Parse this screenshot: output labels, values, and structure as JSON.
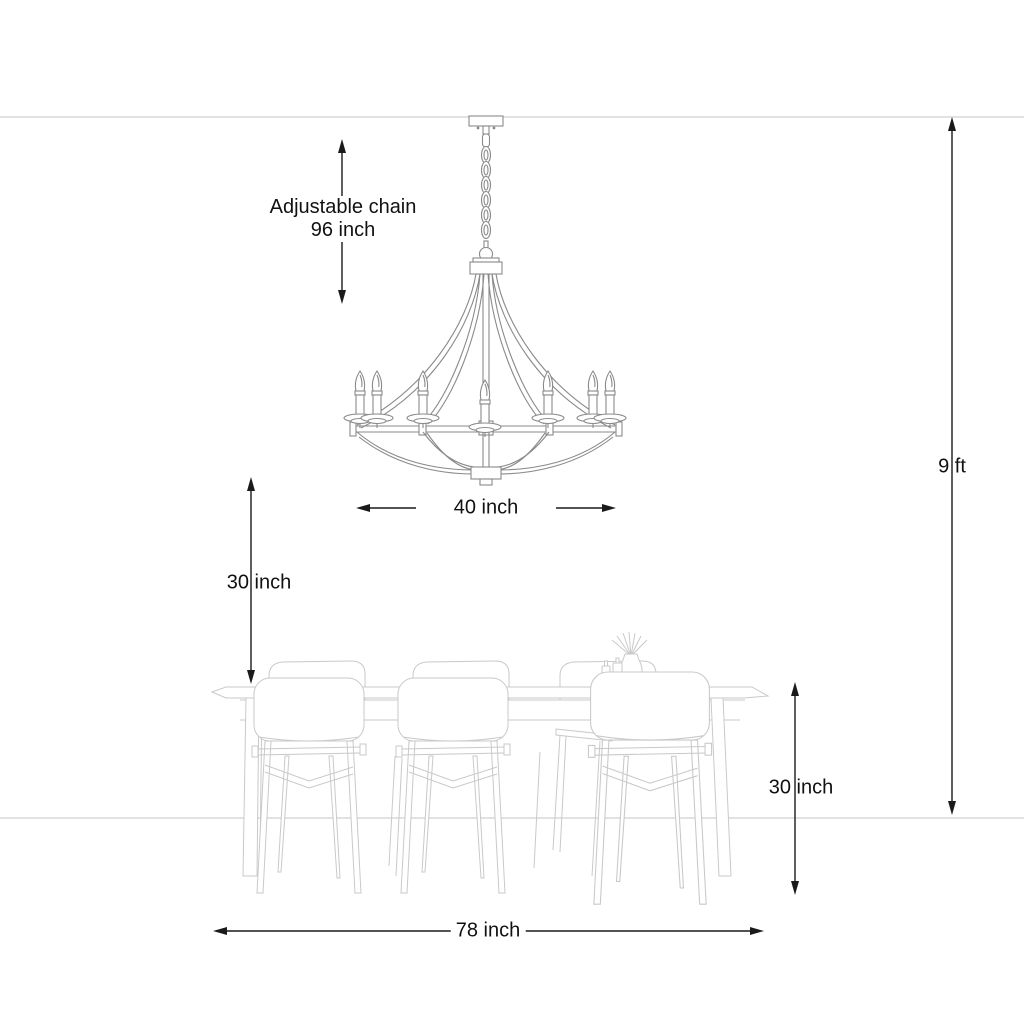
{
  "scene": {
    "type": "product-dimension-diagram",
    "objects": {
      "chandelier": "candle chandelier on adjustable chain",
      "table": "dining table",
      "chairs": "dining chairs",
      "decor": "reed diffuser and bottles on table"
    }
  },
  "colors": {
    "background": "#ffffff",
    "room_line": "#d8d8d8",
    "furniture_line": "#c9c9c9",
    "fixture_line": "#8a8a8a",
    "dimension_line": "#1a1a1a",
    "label_text": "#111111"
  },
  "dimensions": {
    "chain": {
      "label_line1": "Adjustable chain",
      "label_line2": "96 inch",
      "value": 96,
      "unit": "inch"
    },
    "fixture_width": {
      "label": "40 inch",
      "value": 40,
      "unit": "inch"
    },
    "fixture_clearance": {
      "label": "30 inch",
      "value": 30,
      "unit": "inch"
    },
    "ceiling_height": {
      "label": "9 ft",
      "value": 9,
      "unit": "ft"
    },
    "table_height": {
      "label": "30 inch",
      "value": 30,
      "unit": "inch"
    },
    "table_length": {
      "label": "78 inch",
      "value": 78,
      "unit": "inch"
    }
  }
}
